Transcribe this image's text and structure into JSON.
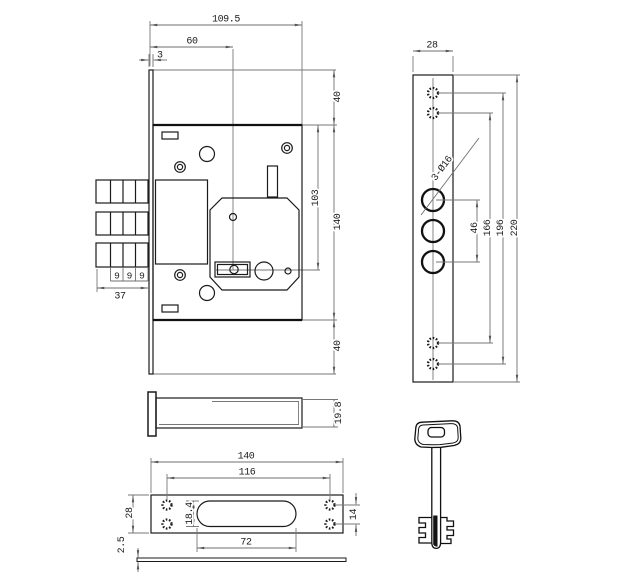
{
  "drawing": {
    "front_view": {
      "dim_width_overall": "109.5",
      "dim_backset": "60",
      "dim_faceplate_thickness": "3",
      "dim_top_offset": "40",
      "dim_key_center": "103",
      "dim_case_height": "140",
      "dim_bottom_offset": "40",
      "dim_bolt_seg_1": "9",
      "dim_bolt_seg_2": "9",
      "dim_bolt_seg_3": "9",
      "dim_bolt_throw": "37"
    },
    "faceplate_view": {
      "dim_width": "28",
      "note_holes": "3-Ø16",
      "dim_bolt_hole_span": "46",
      "dim_screw_span_inner": "166",
      "dim_screw_span_outer": "196",
      "dim_height": "220"
    },
    "side_view": {
      "dim_thickness": "19.8"
    },
    "strike_view": {
      "dim_length": "140",
      "dim_screw_span": "116",
      "dim_slot_height": "18.4",
      "dim_slot_length": "72",
      "dim_screw_gap": "14",
      "dim_height": "28",
      "dim_plate_thickness": "2.5"
    }
  }
}
